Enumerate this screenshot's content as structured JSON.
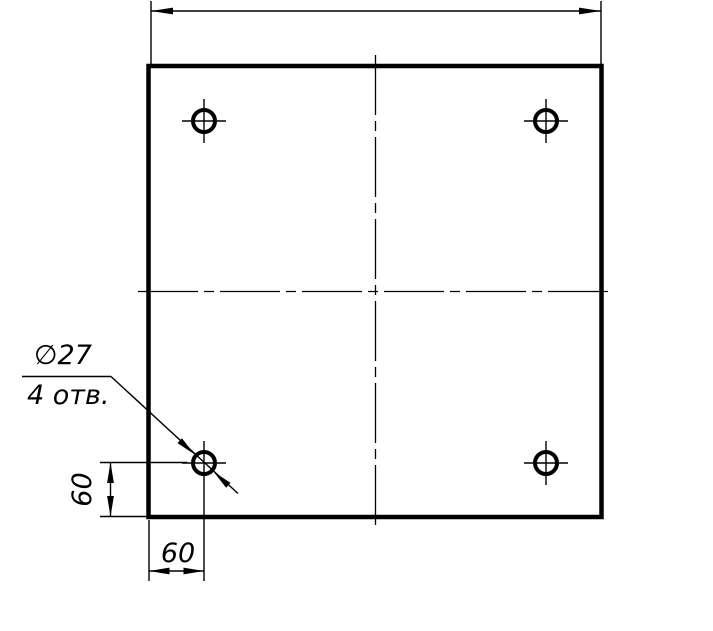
{
  "canvas": {
    "width": 713,
    "height": 631,
    "background": "#ffffff",
    "line_color": "#000000"
  },
  "figure": {
    "type": "technical-drawing",
    "subject": "square plate with 4 corner holes",
    "holes_count": 4
  },
  "annotations": {
    "hole_diameter_label": "∅27",
    "hole_count_note": "4 отв.",
    "vertical_offset_dim": "60",
    "horizontal_offset_dim": "60"
  }
}
